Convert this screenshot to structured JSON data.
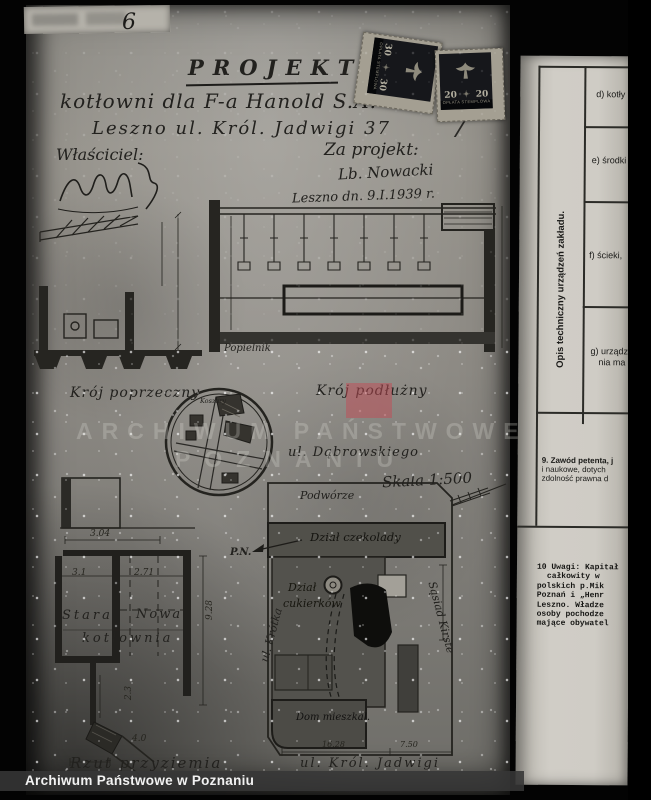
{
  "scan": {
    "corner_number": "6",
    "pencil_page_number": "7",
    "archive_bar_text": "Archiwum Państwowe w Poznaniu"
  },
  "watermark": {
    "line1": "ARCHIWUM PAŃSTWOWE",
    "line2": "POZNANIU",
    "accent_color": "#c24b55"
  },
  "title_block": {
    "title": "PROJEKT",
    "line2": "kotłowni dla F-a Hanold S.A.",
    "line3": "Leszno ul. Król. Jadwigi 37",
    "owner_label": "Właściciel:",
    "author_label": "Za projekt:",
    "author_signature": "Lb. Nowacki",
    "date_line": "Leszno dn. 9.I.1939 r."
  },
  "stamps": {
    "caption": "OPŁATA STEMPLOWA",
    "left_value": "30",
    "right_value": "20"
  },
  "sections": {
    "cross_section": "Krój poprzeczny",
    "long_section": "Krój podłużny",
    "ash_pit": "Popielnik",
    "ground_plan": "Rzut przyziemia",
    "old_boiler_line1": "Stara",
    "old_boiler_line2": "kotłownia",
    "new_boiler": "Nowa"
  },
  "ground_plan_dims": {
    "top": "3.04",
    "left_span": "3.1",
    "right_span": "2.71",
    "height": "9.28",
    "lower": "2.3",
    "bottom": "4.0"
  },
  "site_plan": {
    "scale": "Skala 1:500",
    "street_top": "ul. Dąbrowskiego",
    "street_left": "ul. Krótka",
    "street_bottom": "ul. Król. Jadwigi",
    "north_marker": "P.N.",
    "courtyard": "Podwórze",
    "chocolate_dept": "Dział czekolady",
    "candy_dept_line1": "Dział",
    "candy_dept_line2": "cukierków",
    "house": "Dom mieszkal.",
    "neighbor": "Sąsiad Kirste",
    "inset_label": "Koszary",
    "dim_main": "16.28",
    "dim_side": "7.50"
  },
  "form_page": {
    "vertical_header": "Opis techniczny urządzeń zakładu.",
    "cell_d": "d) kotły",
    "cell_e": "e) środki",
    "cell_f": "f) ścieki,",
    "cell_g_line1": "g) urządze-",
    "cell_g_line2": "nia ma",
    "item9_lines": [
      "9. Zawód petenta, j",
      "i naukowe, dotych",
      "zdolność prawna d"
    ],
    "item10_lines": [
      "10 Uwagi: Kapitał",
      "całkowity w",
      "polskich p.Mik",
      "Poznań i „Henr",
      "Leszno. Władze",
      "osoby pochodze",
      "mające obywatel"
    ]
  }
}
